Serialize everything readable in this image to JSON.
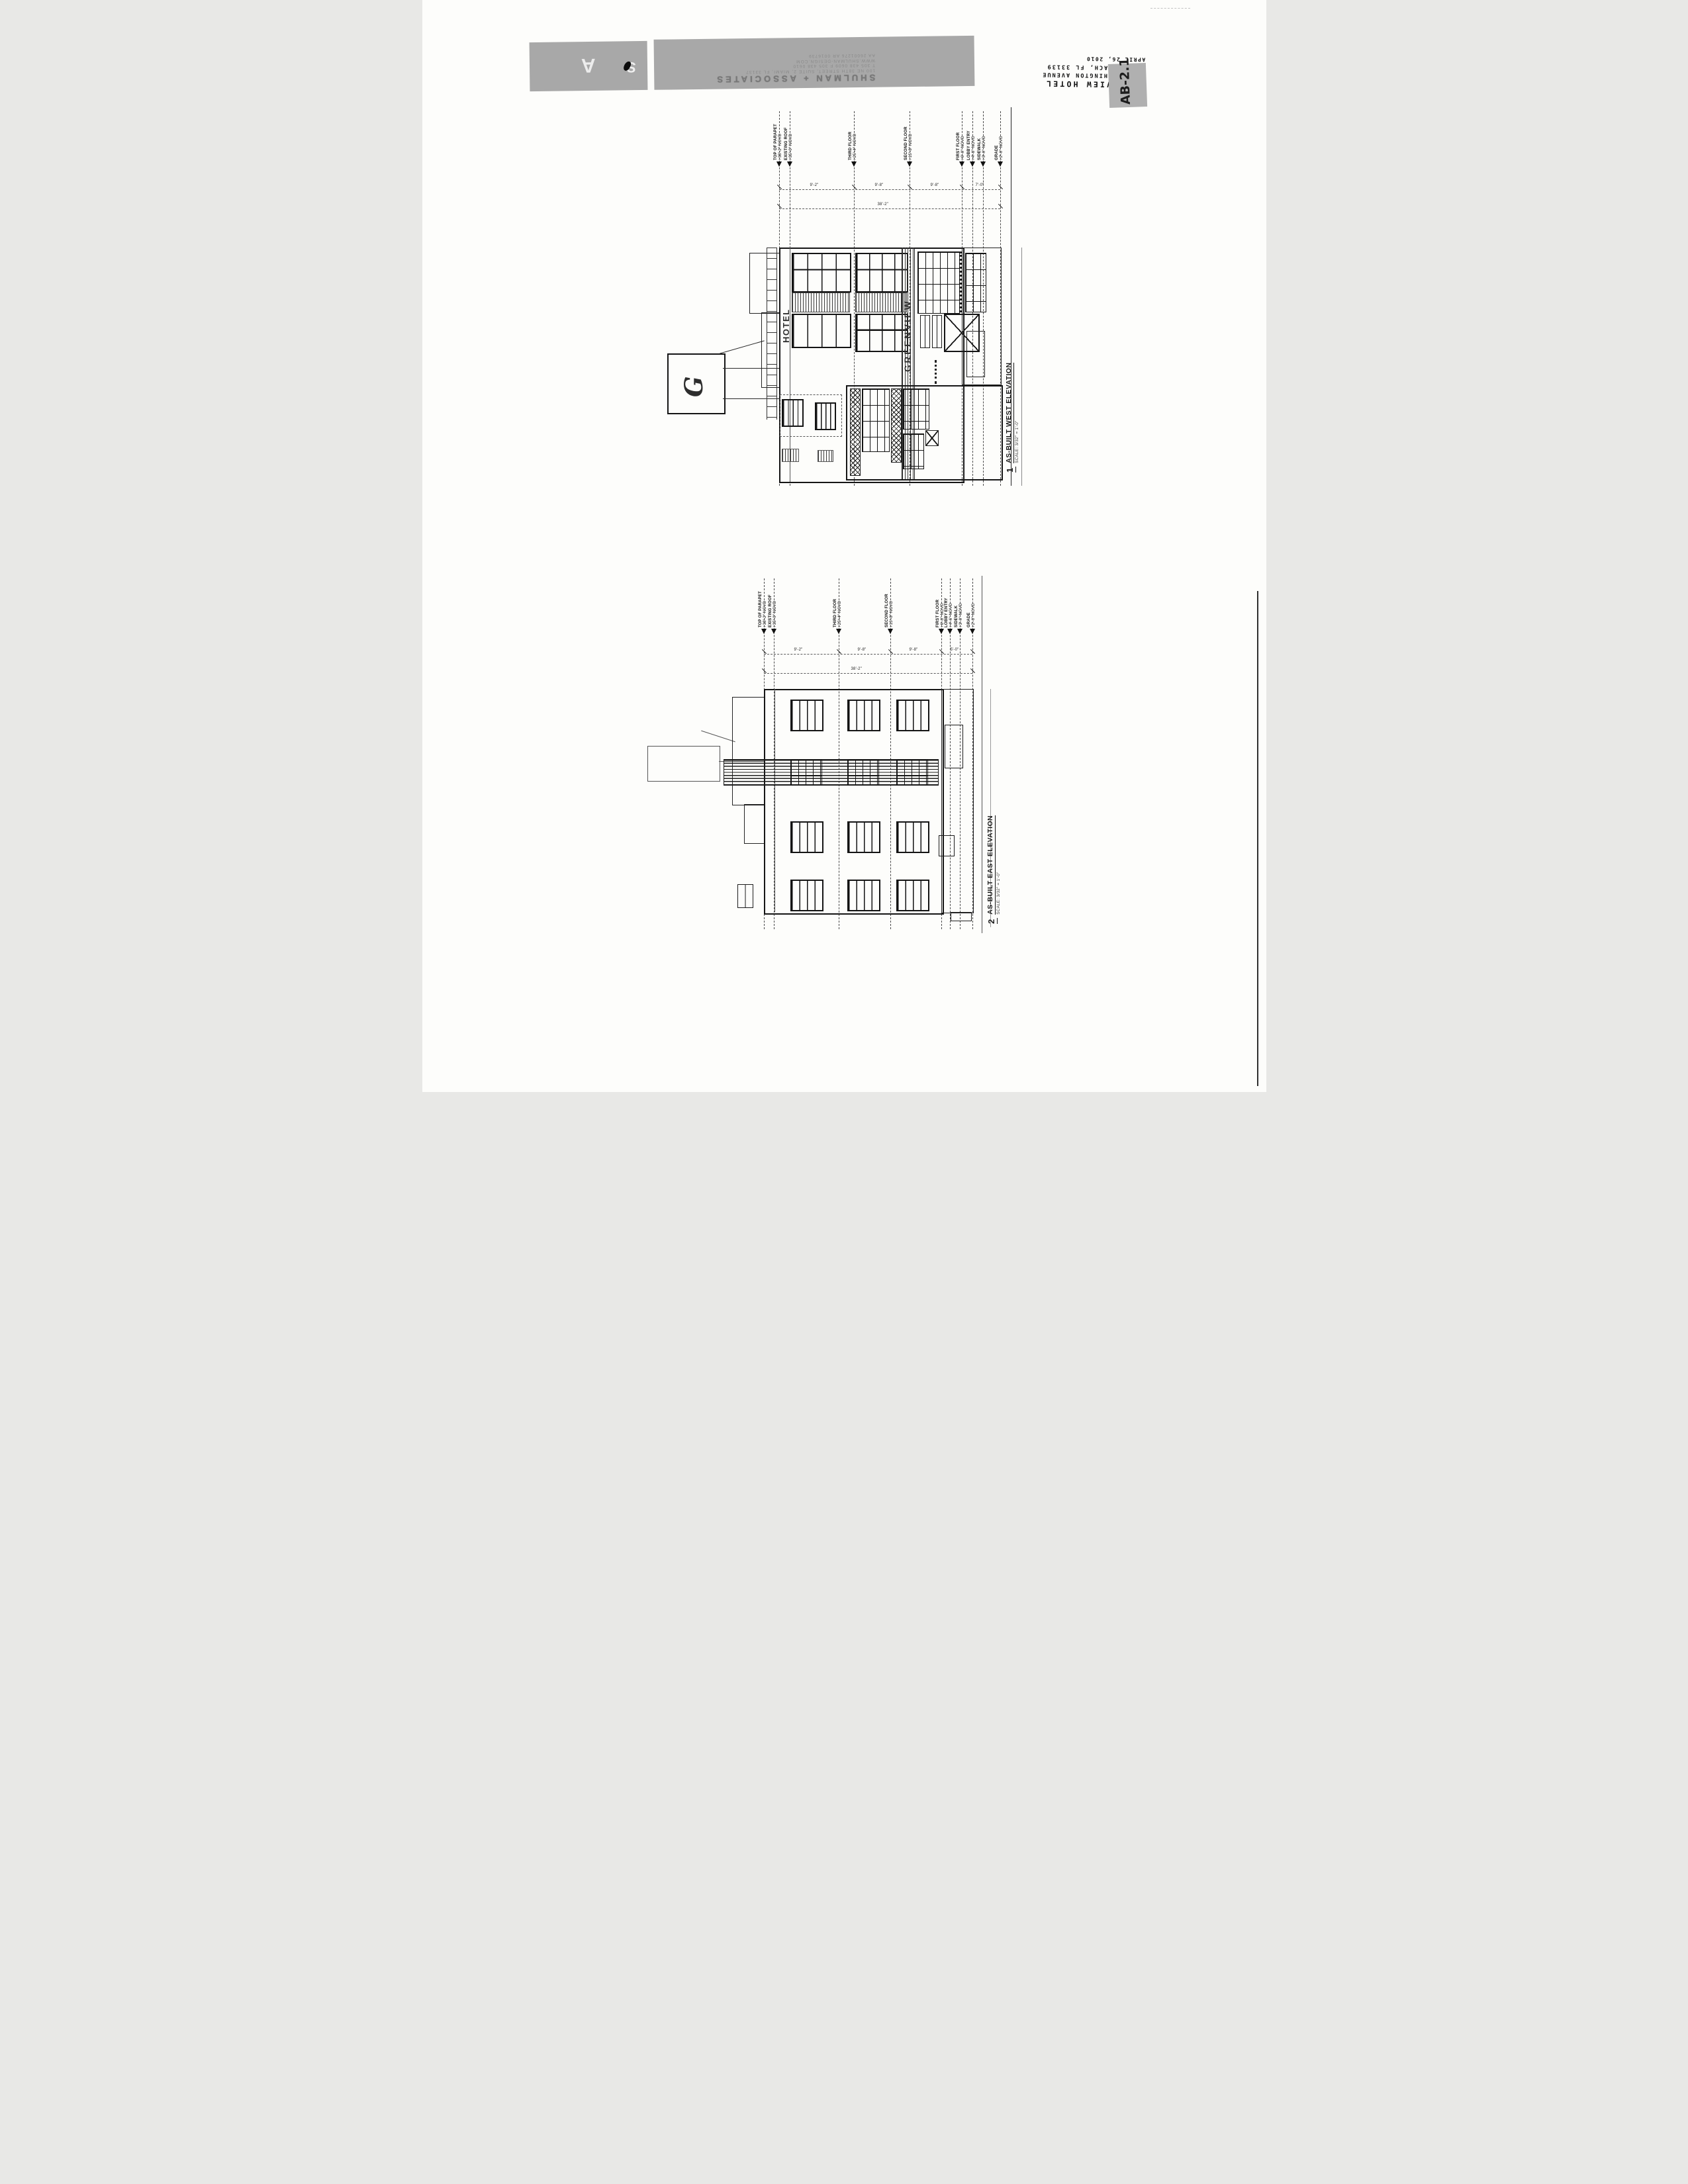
{
  "firm": {
    "logo_a": "A",
    "logo_s": "S",
    "name": "SHULMAN + ASSOCIATES",
    "info_lines": [
      "100 NE 38TH STREET, SUITE 2, MIAMI, FL 33137",
      "T 305 438 0609   F 305 438 0610",
      "WWW.SHULMAN-DESIGN.COM",
      "AA 26001276   AR 0016739"
    ]
  },
  "titleblock": {
    "project": "GREENVIEW HOTEL",
    "address_line1": "1671 WASHINGTON AVENUE",
    "address_line2": "MIAMI BEACH, FL 33139",
    "date": "APRIL 26, 2010",
    "sheet_number": "AB-2.1"
  },
  "drawings": [
    {
      "number": "1",
      "title": "AS-BUILT WEST ELEVATION",
      "scale": "SCALE: 3/32\" = 1'-0\"",
      "signage": {
        "hotel": "HOTEL",
        "greenview": "GREENVIEW",
        "logo_g": "G"
      },
      "levels": [
        {
          "name": "TOP OF PARAPET",
          "elev": "+38'-2\" NGVD"
        },
        {
          "name": "EXISTING ROOF",
          "elev": "+35'-0\" NGVD"
        },
        {
          "name": "THIRD FLOOR",
          "elev": "+25'-4\" NGVD"
        },
        {
          "name": "SECOND FLOOR",
          "elev": "+15'-8\" NGVD"
        },
        {
          "name": "FIRST FLOOR",
          "elev": "+6'-0\" NGVD"
        },
        {
          "name": "LOBBY ENTRY",
          "elev": "+4'-6\" NGVD"
        },
        {
          "name": "SIDEWALK",
          "elev": "+3'-0\" NGVD"
        },
        {
          "name": "GRADE",
          "elev": "+2'-0\" NGVD"
        }
      ],
      "dims": {
        "segments": [
          "9'-2\"",
          "9'-8\"",
          "9'-8\"",
          "7'-0\""
        ],
        "overall": "38'-2\""
      }
    },
    {
      "number": "2",
      "title": "AS-BUILT EAST ELEVATION",
      "scale": "SCALE: 3/32\" = 1'-0\"",
      "levels": [
        {
          "name": "TOP OF PARAPET",
          "elev": "+38'-2\" NGVD"
        },
        {
          "name": "EXISTING ROOF",
          "elev": "+35'-0\" NGVD"
        },
        {
          "name": "THIRD FLOOR",
          "elev": "+25'-4\" NGVD"
        },
        {
          "name": "SECOND FLOOR",
          "elev": "+15'-8\" NGVD"
        },
        {
          "name": "FIRST FLOOR",
          "elev": "+6'-0\" NGVD"
        },
        {
          "name": "LOBBY ENTRY",
          "elev": "+4'-6\" NGVD"
        },
        {
          "name": "SIDEWALK",
          "elev": "+3'-0\" NGVD"
        },
        {
          "name": "GRADE",
          "elev": "+2'-0\" NGVD"
        }
      ],
      "dims": {
        "segments": [
          "9'-2\"",
          "9'-8\"",
          "9'-8\"",
          "5'-0\""
        ],
        "overall": "38'-2\""
      }
    }
  ],
  "colors": {
    "paper": "#fdfdfb",
    "ink": "#1b1b1b",
    "banner_gray": "#a8a8a8",
    "sheetbox_gray": "#b0b0b0"
  }
}
